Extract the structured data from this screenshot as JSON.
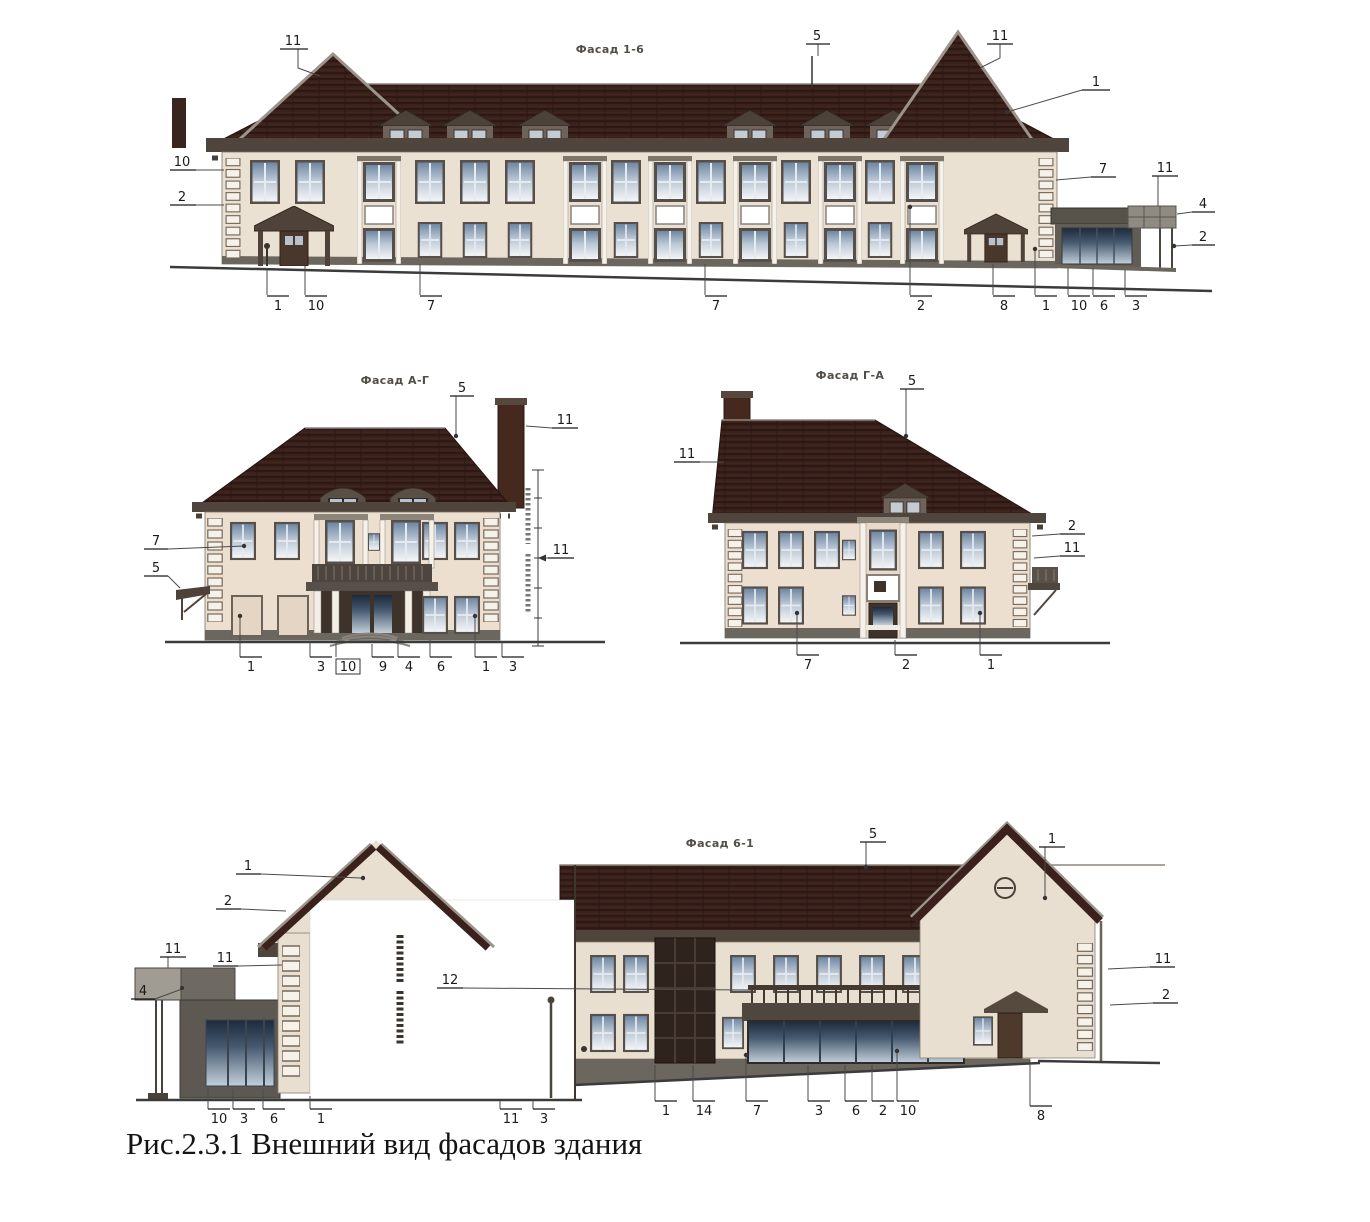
{
  "caption": "Рис.2.3.1 Внешний вид фасадов здания",
  "colors": {
    "roof": "#3a211c",
    "wall": "#eae1d2",
    "trim": "#50453c",
    "quoin": "#f6f2ea",
    "glass_light": "#c7d2dd",
    "glass_dark": "#2c3c50"
  },
  "facade_top": {
    "title": "Фасад 1-6",
    "callouts": [
      "11",
      "5",
      "11",
      "1",
      "10",
      "2",
      "7",
      "11",
      "4",
      "2",
      "1",
      "10",
      "7",
      "7",
      "2",
      "8",
      "1",
      "10",
      "6",
      "3"
    ]
  },
  "facade_left": {
    "title": "Фасад А-Г",
    "callouts": [
      "5",
      "11",
      "7",
      "5",
      "11",
      "1",
      "3",
      "10",
      "9",
      "4",
      "6",
      "1",
      "3"
    ]
  },
  "facade_right": {
    "title": "Фасад Г-А",
    "callouts": [
      "5",
      "11",
      "2",
      "11",
      "7",
      "2",
      "1"
    ]
  },
  "facade_bottom": {
    "title": "Фасад 6-1",
    "callouts": [
      "5",
      "1",
      "1",
      "2",
      "11",
      "11",
      "4",
      "12",
      "10",
      "3",
      "6",
      "1",
      "11",
      "3",
      "1",
      "14",
      "7",
      "3",
      "6",
      "2",
      "10",
      "8",
      "11",
      "2"
    ]
  }
}
